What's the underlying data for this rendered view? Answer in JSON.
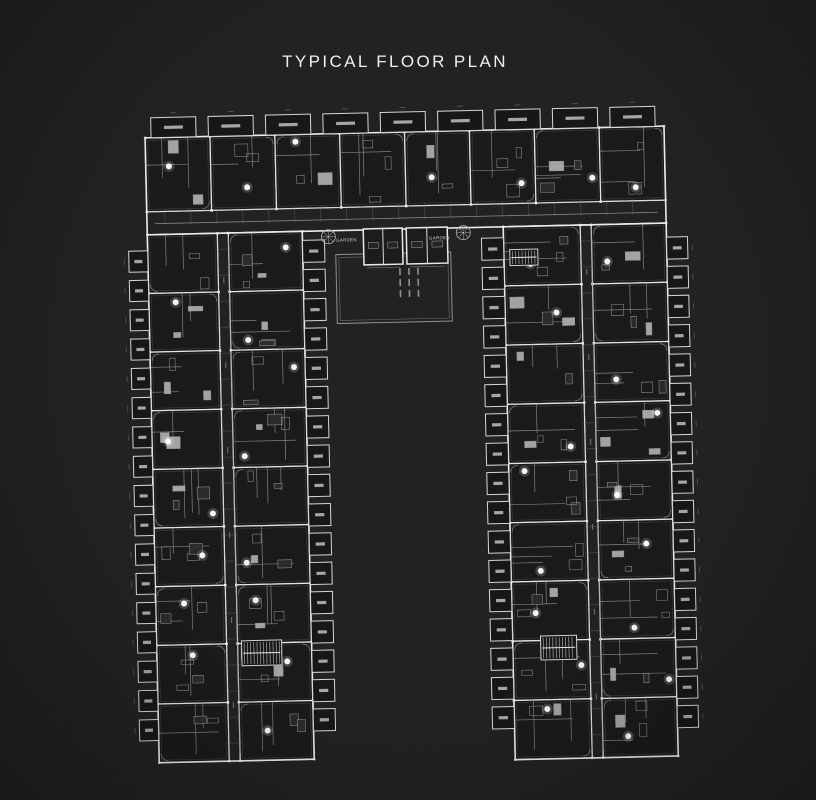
{
  "title": "TYPICAL FLOOR PLAN",
  "plan": {
    "garden_label_left": "GARDEN",
    "garden_label_right": "GARDEN",
    "rotation_deg": -1.3,
    "colors": {
      "background": "#1b1b1b",
      "wall_bright": "#e4e4e4",
      "wall_dim": "#8f8f8f",
      "unit_fill": "#131313",
      "balcony_stroke": "#d4d4d4",
      "accent_dot": "#ffffff",
      "label_text": "#cdcdcd"
    },
    "layout": {
      "canvas": {
        "w": 816,
        "h": 800
      },
      "rotation_center": {
        "x": 408,
        "y": 440
      },
      "top_band": {
        "x": 152,
        "y": 132,
        "x2": 671,
        "y2": 229,
        "units": 8,
        "corridor_y1": 206,
        "corridor_y2": 218
      },
      "top_balconies": {
        "x_start": 158,
        "pitch": 57.4,
        "count": 9,
        "w": 45,
        "h": 20,
        "y": 112
      },
      "left_wing": {
        "x": 152,
        "x2": 307,
        "y": 229,
        "y2": 757,
        "rows": 9,
        "corridor_x1": 222,
        "corridor_x2": 233
      },
      "left_outer_balconies": {
        "x": 133,
        "w": 19,
        "y_start": 245,
        "pitch": 29.3,
        "count": 17,
        "h": 21
      },
      "left_inner_balconies": {
        "x": 307,
        "w": 22,
        "y_start": 238,
        "pitch": 29.3,
        "count": 17,
        "h": 22
      },
      "right_wing": {
        "x": 508,
        "x2": 671,
        "y": 229,
        "y2": 762,
        "rows": 9,
        "corridor_x1": 585,
        "corridor_x2": 596
      },
      "right_inner_balconies": {
        "x": 486,
        "w": 22,
        "y_start": 240,
        "pitch": 29.3,
        "count": 17,
        "h": 22
      },
      "right_outer_balconies": {
        "x": 671,
        "w": 21,
        "y_start": 243,
        "pitch": 29.3,
        "count": 17,
        "h": 22
      },
      "cores": [
        {
          "x": 368,
          "y": 228,
          "w": 39,
          "h": 36
        },
        {
          "x": 411,
          "y": 228,
          "w": 41,
          "h": 36
        }
      ],
      "stairs": [
        {
          "x": 237,
          "y": 637,
          "w": 40,
          "h": 25
        },
        {
          "x": 536,
          "y": 639,
          "w": 36,
          "h": 24
        },
        {
          "x": 514,
          "y": 252,
          "w": 28,
          "h": 16
        }
      ],
      "garden_rect": {
        "x": 340,
        "y": 253,
        "x2": 455,
        "y2": 322
      },
      "trees": [
        {
          "cx": 333,
          "cy": 235,
          "r": 7
        },
        {
          "cx": 468,
          "cy": 234,
          "r": 7
        }
      ],
      "garden_label_pos": [
        {
          "x": 351,
          "y": 240
        },
        {
          "x": 444,
          "y": 240
        }
      ],
      "pool_text_pos": {
        "x": 403,
        "y": 268
      }
    }
  }
}
